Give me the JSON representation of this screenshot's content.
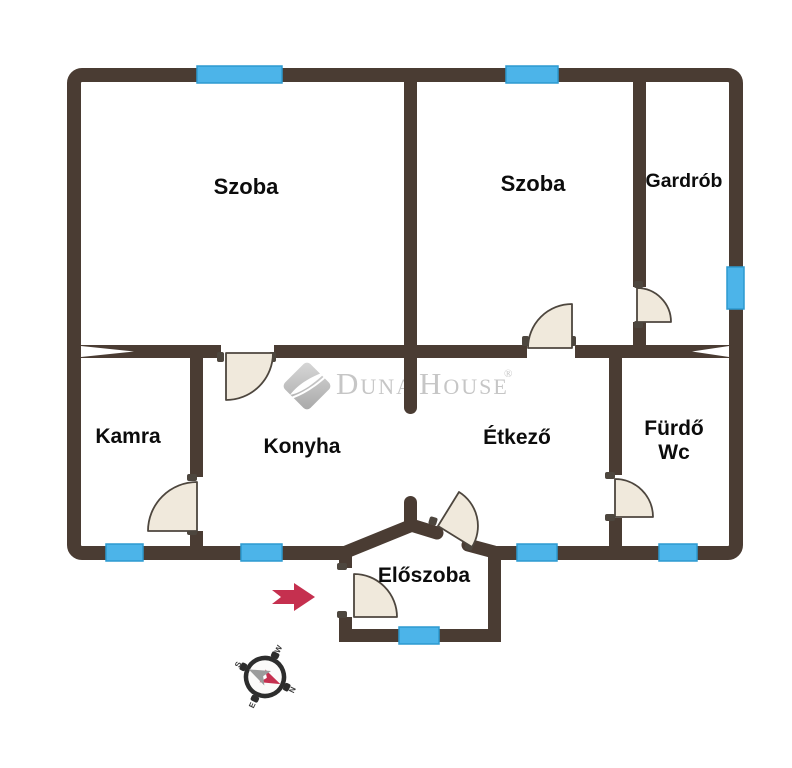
{
  "colors": {
    "background": "#ffffff",
    "wall": "#4a3c33",
    "window": "#4cb4e9",
    "window_border": "#2d9ad0",
    "door_fill": "#f0e9dc",
    "door_stroke": "#4d463e",
    "arrow": "#c5304f",
    "logo_gray": "#c6c6c6",
    "text": "#0c0c0c"
  },
  "rooms": {
    "szoba_left": {
      "label": "Szoba"
    },
    "szoba_right": {
      "label": "Szoba"
    },
    "gardrob": {
      "label": "Gardrób"
    },
    "kamra": {
      "label": "Kamra"
    },
    "konyha": {
      "label": "Konyha"
    },
    "etkezo": {
      "label": "Étkező"
    },
    "furdo": {
      "label": "Fürdő",
      "label2": "Wc"
    },
    "eloszoba": {
      "label": "Előszoba"
    }
  },
  "watermark": {
    "word1": "Duna",
    "word2": "House",
    "registered": "®"
  },
  "compass": {
    "north": "N",
    "south": "S",
    "east": "E",
    "west": "W"
  },
  "icons": {
    "entrance_arrow": "right-arrow",
    "compass_rose": "compass"
  }
}
